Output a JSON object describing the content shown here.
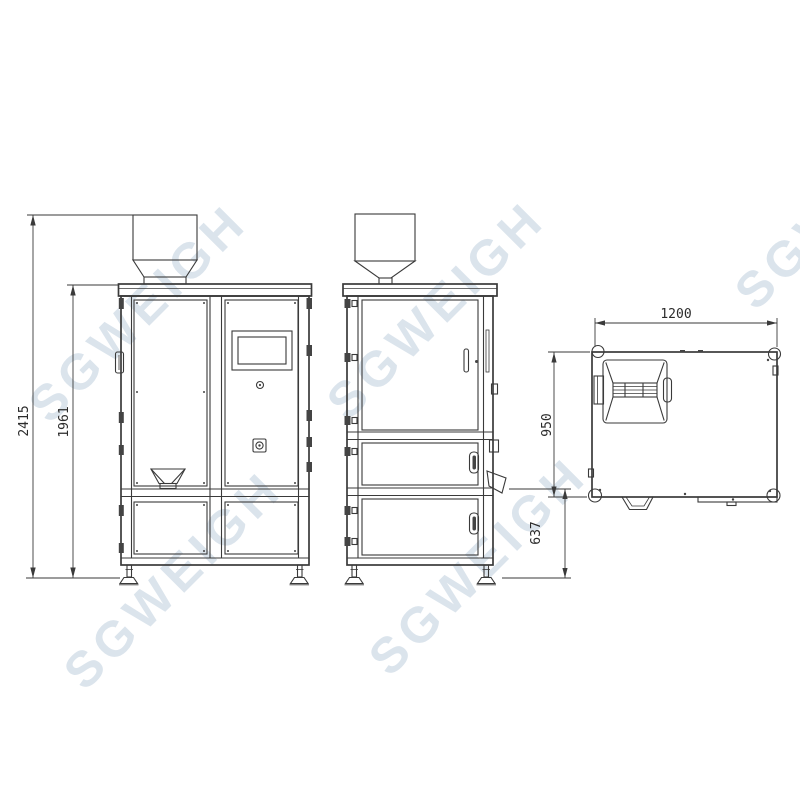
{
  "drawing": {
    "watermark_text": "SGWEIGH",
    "line_color": "#3a3a3a",
    "watermark_color": "#ccd9e5",
    "dimensions": {
      "total_height": "2415",
      "cabinet_height": "1961",
      "discharge_height": "637",
      "top_depth": "950",
      "top_width": "1200"
    }
  }
}
